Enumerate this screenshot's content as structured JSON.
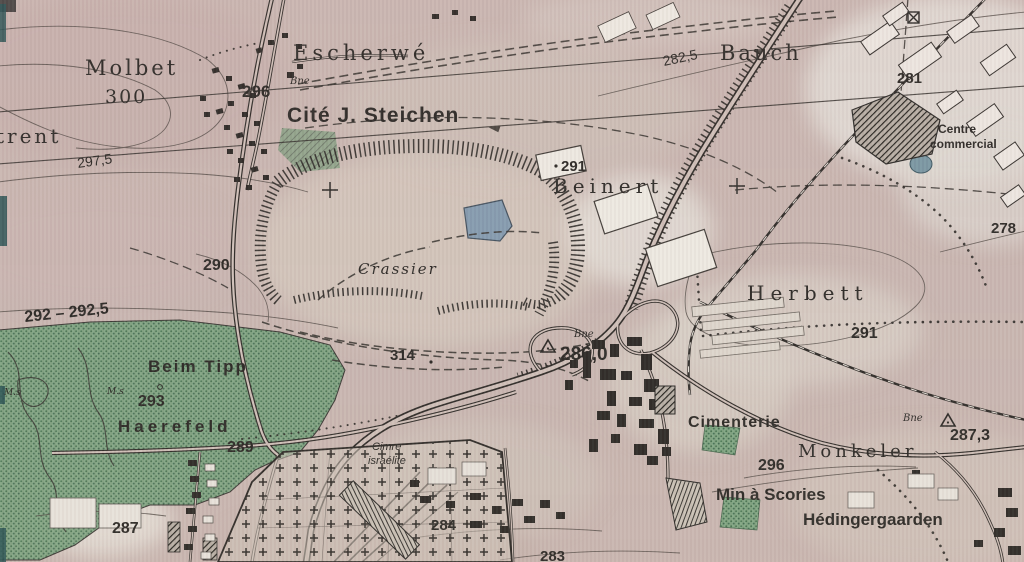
{
  "map": {
    "kind": "scanned-topographic-map",
    "colors": {
      "paper_pink": "#c9b6af",
      "forest_green": "#77a179",
      "forest_dot": "#3f6c49",
      "pond_blue": "#8099ad",
      "ink": "#23211c",
      "light_patch": "#ddd5ca",
      "scan_teal": "#1d4a4a"
    }
  },
  "labels": {
    "molbet": "Molbet",
    "elev300": "300",
    "trent": "trent",
    "c2975": "297,5",
    "escherwe": "Escherwé",
    "elev296top": "296",
    "bne_top": "Bne",
    "cite": "Cité J. Steichen",
    "c2825": "282,5",
    "bauch": "Bauch",
    "elev281": "281",
    "centre_line1": "Centre",
    "centre_line2": "commercial",
    "elev291_beinert": "291",
    "beinert": "Beinert",
    "elev278": "278",
    "elev290": "290",
    "crassier": "Crassier",
    "c292": "292 – 292,5",
    "herbett": "Herbett",
    "elev291_herbett": "291",
    "beimtipp": "Beim Tipp",
    "ms_left": "M.s",
    "ms_mid": "M.s",
    "elev293": "293",
    "haerefeld": "Haerefeld",
    "elev314": "314",
    "bne_286": "Bne",
    "elev2860": "286,0",
    "elev289": "289",
    "cimenterie": "Cimenterie",
    "bne_287": "Bne",
    "elev2873": "287,3",
    "monkeler": "Monkeler",
    "elev296bot": "296",
    "cim_isr_1": "Cimre",
    "cim_isr_2": "israélite",
    "minscories": "Min à Scories",
    "hedingergaarden": "Hédingergaarden",
    "elev284": "284",
    "elev283": "283",
    "elev287": "287"
  }
}
